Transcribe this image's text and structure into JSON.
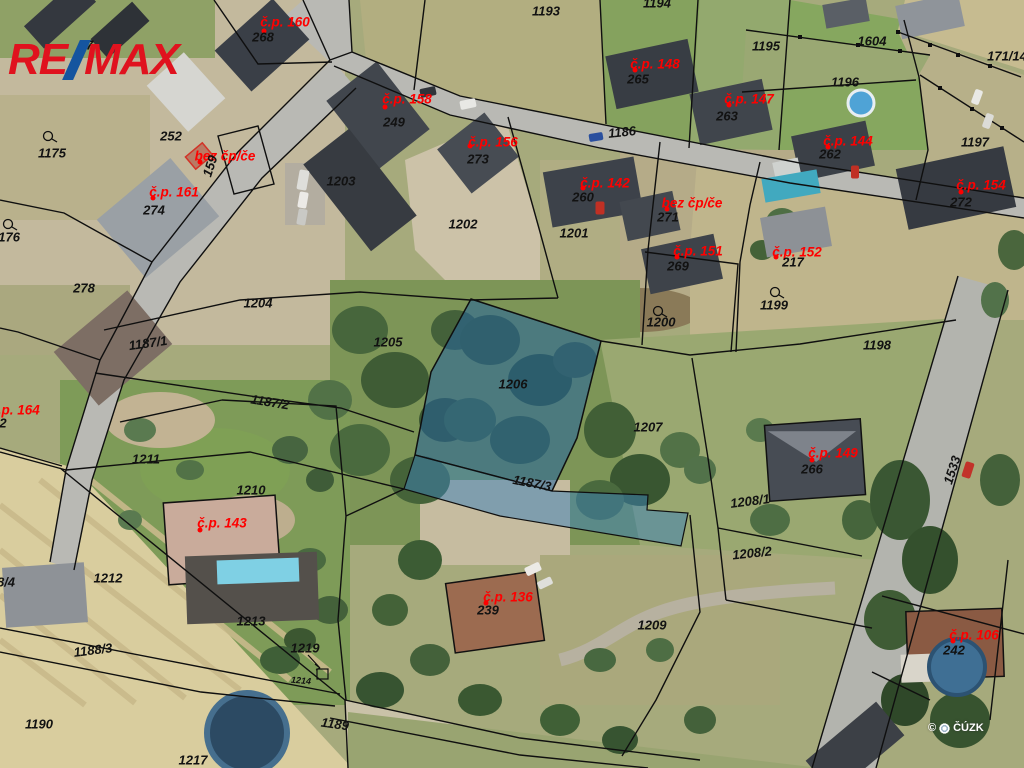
{
  "brand": {
    "name": "RE/MAX",
    "re": "RE",
    "max": "MAX",
    "red": "#e0121e",
    "blue": "#15559f"
  },
  "watermark": {
    "copyright": "©",
    "org": "ČÚZK"
  },
  "palette": {
    "label_red": "#fe0000",
    "label_black": "#121212",
    "highlight_parcel_blue": "#2f6fae",
    "road_gray": "#b9b9b4",
    "field_tan": "#d9cd9e"
  },
  "map": {
    "red_labels": [
      {
        "text": "č.p. 160",
        "x": 285,
        "y": 22,
        "dot": [
          -21,
          9
        ]
      },
      {
        "text": "č.p. 158",
        "x": 407,
        "y": 99,
        "dot": [
          -22,
          8
        ]
      },
      {
        "text": "č.p. 156",
        "x": 493,
        "y": 142,
        "dot": [
          -23,
          4
        ]
      },
      {
        "text": "č.p. 148",
        "x": 655,
        "y": 64,
        "dot": [
          -20,
          6
        ]
      },
      {
        "text": "č.p. 147",
        "x": 749,
        "y": 99,
        "dot": [
          -20,
          6
        ]
      },
      {
        "text": "č.p. 144",
        "x": 848,
        "y": 141,
        "dot": [
          -20,
          6
        ]
      },
      {
        "text": "č.p. 154",
        "x": 981,
        "y": 185,
        "dot": [
          -20,
          7
        ]
      },
      {
        "text": "č.p. 161",
        "x": 174,
        "y": 192,
        "dot": [
          -21,
          6
        ]
      },
      {
        "text": "bez čp/če",
        "x": 225,
        "y": 156,
        "dot": [
          -25,
          6
        ]
      },
      {
        "text": "č.p. 142",
        "x": 605,
        "y": 183,
        "dot": [
          -22,
          5
        ]
      },
      {
        "text": "bez čp/če",
        "x": 692,
        "y": 203,
        "dot": [
          -25,
          6
        ]
      },
      {
        "text": "č.p. 151",
        "x": 698,
        "y": 251,
        "dot": [
          -21,
          6
        ]
      },
      {
        "text": "č.p. 152",
        "x": 797,
        "y": 252,
        "dot": [
          -21,
          5
        ]
      },
      {
        "text": "č.p. 164",
        "x": 15,
        "y": 410
      },
      {
        "text": "č.p. 143",
        "x": 222,
        "y": 523,
        "dot": [
          -22,
          7
        ]
      },
      {
        "text": "č.p. 149",
        "x": 833,
        "y": 453,
        "dot": [
          -21,
          7
        ]
      },
      {
        "text": "č.p. 136",
        "x": 508,
        "y": 597,
        "dot": [
          -22,
          6
        ]
      },
      {
        "text": "č.p. 106",
        "x": 974,
        "y": 635,
        "dot": [
          -21,
          6
        ]
      }
    ],
    "black_labels": [
      {
        "text": "268",
        "x": 263,
        "y": 37
      },
      {
        "text": "17",
        "x": 86,
        "y": 45
      },
      {
        "text": "1193",
        "x": 546,
        "y": 11
      },
      {
        "text": "1194",
        "x": 657,
        "y": 3
      },
      {
        "text": "1195",
        "x": 766,
        "y": 46
      },
      {
        "text": "1604",
        "x": 872,
        "y": 41
      },
      {
        "text": "1196",
        "x": 845,
        "y": 82
      },
      {
        "text": "171/14",
        "x": 1007,
        "y": 56
      },
      {
        "text": "1197",
        "x": 975,
        "y": 142
      },
      {
        "text": "263",
        "x": 727,
        "y": 116
      },
      {
        "text": "262",
        "x": 830,
        "y": 154
      },
      {
        "text": "265",
        "x": 638,
        "y": 79
      },
      {
        "text": "249",
        "x": 394,
        "y": 122
      },
      {
        "text": "273",
        "x": 478,
        "y": 159
      },
      {
        "text": "252",
        "x": 171,
        "y": 136
      },
      {
        "text": "159",
        "x": 210,
        "y": 166,
        "rot": -72
      },
      {
        "text": "1175",
        "x": 52,
        "y": 153
      },
      {
        "text": "1176",
        "x": 6,
        "y": 237
      },
      {
        "text": "274",
        "x": 154,
        "y": 210
      },
      {
        "text": "278",
        "x": 84,
        "y": 288
      },
      {
        "text": "1203",
        "x": 341,
        "y": 181
      },
      {
        "text": "1202",
        "x": 463,
        "y": 224
      },
      {
        "text": "260",
        "x": 583,
        "y": 197
      },
      {
        "text": "1201",
        "x": 574,
        "y": 233
      },
      {
        "text": "1186",
        "x": 622,
        "y": 132,
        "rot": -6
      },
      {
        "text": "272",
        "x": 961,
        "y": 202
      },
      {
        "text": "271",
        "x": 668,
        "y": 217
      },
      {
        "text": "269",
        "x": 678,
        "y": 266
      },
      {
        "text": "217",
        "x": 793,
        "y": 262
      },
      {
        "text": "1199",
        "x": 774,
        "y": 305
      },
      {
        "text": "1200",
        "x": 661,
        "y": 322
      },
      {
        "text": "1198",
        "x": 877,
        "y": 345
      },
      {
        "text": "1204",
        "x": 258,
        "y": 303
      },
      {
        "text": "1205",
        "x": 388,
        "y": 342
      },
      {
        "text": "1206",
        "x": 513,
        "y": 384
      },
      {
        "text": "1207",
        "x": 648,
        "y": 427
      },
      {
        "text": "1187/1",
        "x": 148,
        "y": 343,
        "rot": -8
      },
      {
        "text": "1187/2",
        "x": 270,
        "y": 402,
        "rot": 9
      },
      {
        "text": "1187/3",
        "x": 532,
        "y": 483,
        "rot": 11
      },
      {
        "text": "266",
        "x": 812,
        "y": 469
      },
      {
        "text": "1208/1",
        "x": 750,
        "y": 501,
        "rot": -7
      },
      {
        "text": "1208/2",
        "x": 752,
        "y": 553,
        "rot": -6
      },
      {
        "text": "1533",
        "x": 952,
        "y": 470,
        "rot": -72
      },
      {
        "text": "242",
        "x": 954,
        "y": 650
      },
      {
        "text": "1209",
        "x": 652,
        "y": 625
      },
      {
        "text": "239",
        "x": 488,
        "y": 610
      },
      {
        "text": "1210",
        "x": 251,
        "y": 490
      },
      {
        "text": "1211",
        "x": 146,
        "y": 459
      },
      {
        "text": "1212",
        "x": 108,
        "y": 578
      },
      {
        "text": "1213",
        "x": 251,
        "y": 621
      },
      {
        "text": "1219",
        "x": 305,
        "y": 648
      },
      {
        "text": "1214",
        "x": 301,
        "y": 681,
        "rot": 5,
        "size": 9
      },
      {
        "text": "1188/3",
        "x": 93,
        "y": 650,
        "rot": -7
      },
      {
        "text": "1190",
        "x": 39,
        "y": 724
      },
      {
        "text": "1189",
        "x": 335,
        "y": 724,
        "rot": 8
      },
      {
        "text": "1217",
        "x": 193,
        "y": 760
      },
      {
        "text": "8/4",
        "x": 6,
        "y": 582
      },
      {
        "text": "2",
        "x": 3,
        "y": 423
      }
    ]
  }
}
